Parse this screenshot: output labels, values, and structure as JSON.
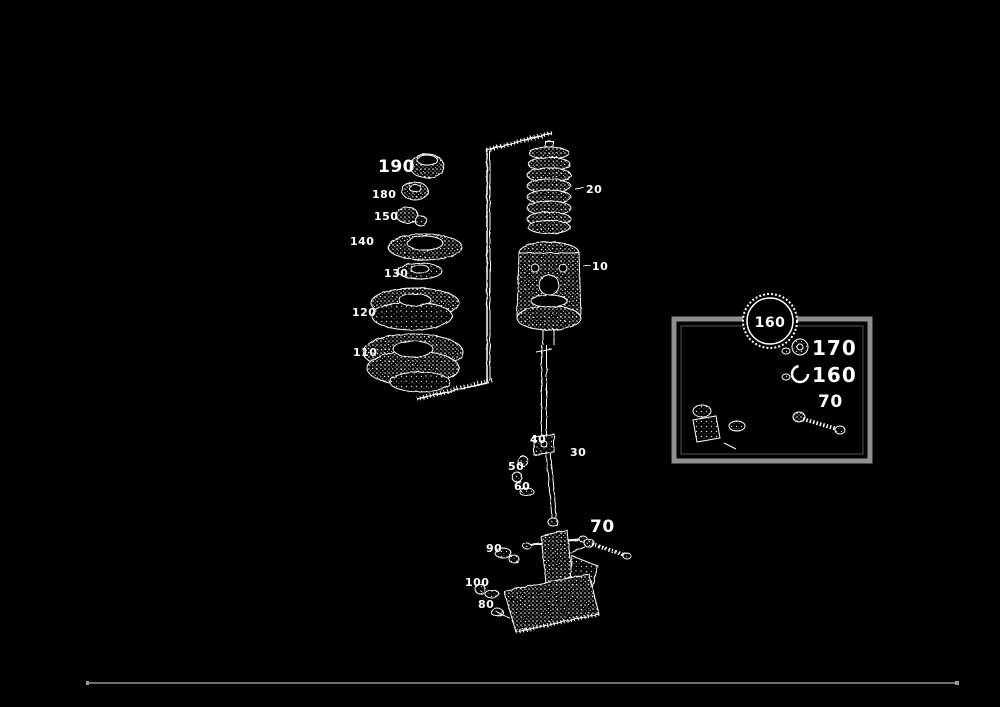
{
  "page": {
    "background": "#000000",
    "ink": "#ffffff",
    "rule_color": "#6e6e6e",
    "inset_border": "#8f8f8f"
  },
  "diagram": {
    "kind": "exploded-parts-diagram",
    "callouts": {
      "left": [
        "190",
        "180",
        "150",
        "140",
        "130",
        "120",
        "110"
      ],
      "spring": "20",
      "canister": "10",
      "link": "30",
      "clevis": "40",
      "pin": "50",
      "washer": "60",
      "bolt": "70",
      "bracket_pin": "90",
      "bracket_left": "100",
      "bracket_lower": "80"
    },
    "inset": {
      "badge": "160",
      "rows": [
        {
          "icon": "washer-icon",
          "label": "170"
        },
        {
          "icon": "snap-ring-icon",
          "label": "160"
        }
      ],
      "bolt_label": "70"
    }
  }
}
